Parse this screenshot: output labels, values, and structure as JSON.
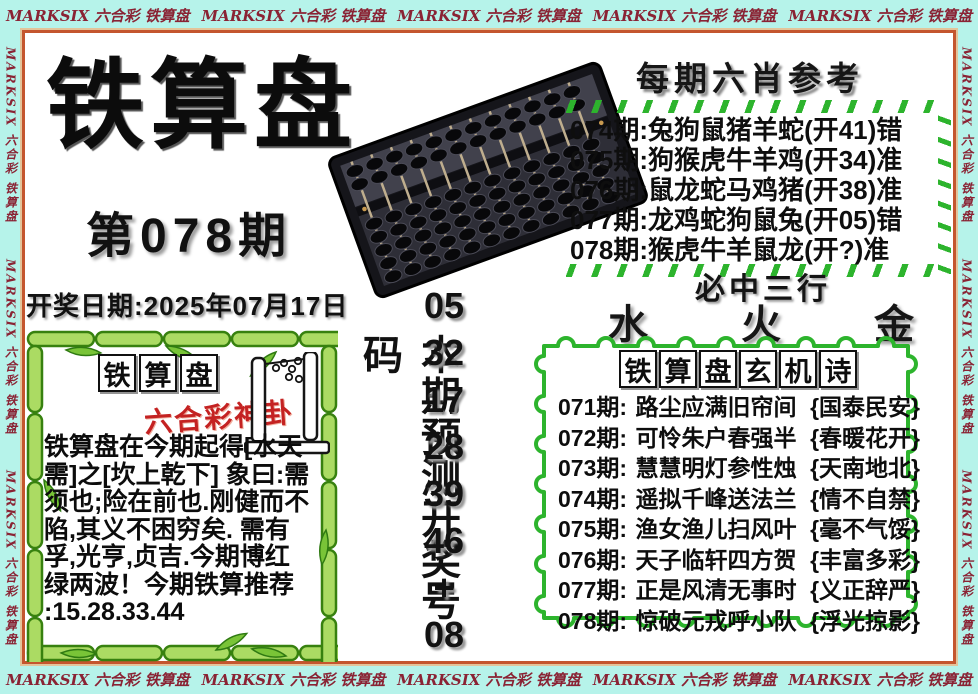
{
  "colors": {
    "border_bg": "#b6f3ea",
    "border_text": "#8a2334",
    "frame": "#c4562e",
    "green": "#2db42d",
    "red_accent": "#c42222"
  },
  "border": {
    "marquee": "MARKSIX 六合彩 铁算盘"
  },
  "masthead": {
    "title": "铁算盘",
    "issue": "第078期",
    "draw_date": "开奖日期:2025年07月17日"
  },
  "six_xiao": {
    "title": "每期六肖参考",
    "rows": [
      {
        "issue": "074期:",
        "animals": "兔狗鼠猪羊蛇",
        "result": "(开41)错"
      },
      {
        "issue": "075期:",
        "animals": "狗猴虎牛羊鸡",
        "result": "(开34)准"
      },
      {
        "issue": "076期:",
        "animals": "鼠龙蛇马鸡猪",
        "result": "(开38)准"
      },
      {
        "issue": "077期:",
        "animals": "龙鸡蛇狗鼠兔",
        "result": "(开05)错"
      },
      {
        "issue": "078期:",
        "animals": "猴虎牛羊鼠龙",
        "result": "(开?)准"
      }
    ]
  },
  "three_rows": {
    "title": "必中三行",
    "elements": [
      "水",
      "火",
      "金"
    ]
  },
  "prediction": {
    "label": "本期预测开奖号码",
    "numbers": [
      "05",
      "32",
      "17",
      "28",
      "39",
      "46",
      "+",
      "08"
    ]
  },
  "bamboo_box": {
    "title_chars": [
      "铁",
      "算",
      "盘"
    ],
    "subtitle": "六合彩神卦",
    "lines": [
      "铁算盘在今期起得[水天",
      "需]之[坎上乾下] 象曰:需",
      "须也;险在前也.刚健而不",
      "陷,其义不困穷矣. 需有",
      "孚,光亨,贞吉.今期博红",
      "绿两波！今期铁算推荐",
      ":15.28.33.44"
    ]
  },
  "mystery_poem": {
    "title_chars": [
      "铁",
      "算",
      "盘",
      "玄",
      "机",
      "诗"
    ],
    "rows": [
      {
        "issue": "071期:",
        "verse": "路尘应满旧帘间",
        "hint": "{国泰民安}"
      },
      {
        "issue": "072期:",
        "verse": "可怜朱户春强半",
        "hint": "{春暖花开}"
      },
      {
        "issue": "073期:",
        "verse": "慧慧明灯参性烛",
        "hint": "{天南地北}"
      },
      {
        "issue": "074期:",
        "verse": "遥拟千峰送法兰",
        "hint": "{情不自禁}"
      },
      {
        "issue": "075期:",
        "verse": "渔女渔儿扫风叶",
        "hint": "{毫不气馁}"
      },
      {
        "issue": "076期:",
        "verse": "天子临轩四方贺",
        "hint": "{丰富多彩}"
      },
      {
        "issue": "077期:",
        "verse": "正是风清无事时",
        "hint": "{义正辞严}"
      },
      {
        "issue": "078期:",
        "verse": "惊破元戎呼小队",
        "hint": "{浮光掠影}"
      }
    ]
  }
}
